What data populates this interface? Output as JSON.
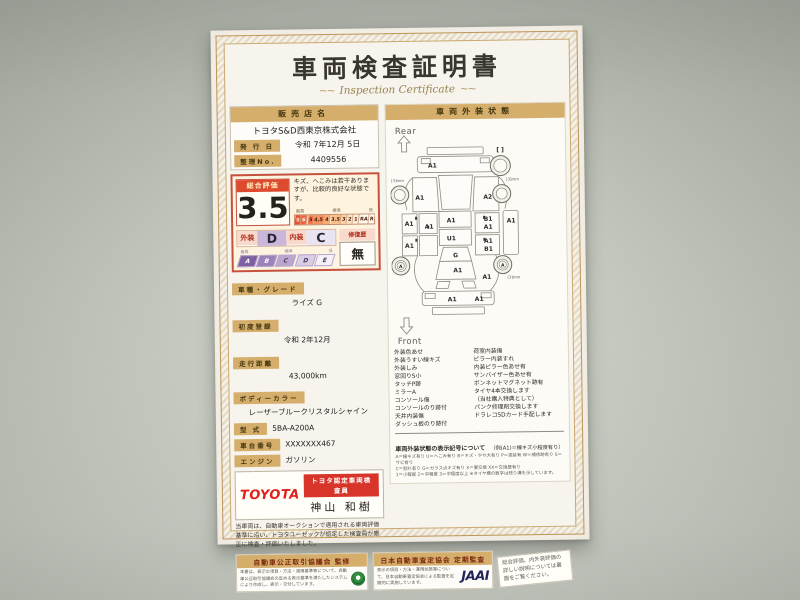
{
  "colors": {
    "accent_tan": "#d5ae6c",
    "accent_red": "#c4513c",
    "toyota_red": "#e0201c"
  },
  "certificate": {
    "title": "車両検査証明書",
    "subtitle": "Inspection Certificate",
    "subtitle_flourish": "~~",
    "dealer": {
      "label": "販売店名",
      "name": "トヨタS&D西東京株式会社"
    },
    "issue_date": {
      "label": "発 行 日",
      "value": "令和 7年12月 5日"
    },
    "control_no": {
      "label": "整理No.",
      "value": "4409556"
    },
    "rating": {
      "label": "総合評価",
      "score": "3.5",
      "comment": "キズ、へこみは若干ありますが、比較的良好な状態です。",
      "scale_high": "最高",
      "scale_mid": "標準",
      "scale_low": "低",
      "scale_cells": [
        "S",
        "6",
        "5",
        "4.5",
        "4",
        "3.5",
        "3",
        "2",
        "1",
        "RA",
        "R"
      ],
      "exterior_label": "外装",
      "exterior_grade": "D",
      "interior_label": "内装",
      "interior_grade": "C",
      "repair_label": "修復歴",
      "repair_value": "無",
      "grade_high": "最高",
      "grade_mid": "標準",
      "grade_low": "低",
      "grade_cells": [
        "A",
        "B",
        "C",
        "D",
        "E"
      ]
    },
    "details": [
      {
        "label": "車種・グレード",
        "value": "ライズ G"
      },
      {
        "label": "初度登録",
        "value": "令和 2年12月"
      },
      {
        "label": "走行距離",
        "value": "43,000km"
      },
      {
        "label": "ボディーカラー",
        "value": "レーザーブルークリスタルシャイン"
      },
      {
        "label": "型 式",
        "value": "5BA-A200A"
      },
      {
        "label": "車台番号",
        "value": "XXXXXXX467"
      },
      {
        "label": "エンジン",
        "value": "ガソリン"
      }
    ],
    "inspector": {
      "brand": "TOYOTA",
      "badge": "トヨタ認定車両検査員",
      "name": "神山 和樹"
    },
    "disclaimer": "当車両は、自動車オークションで適用される車両評価基準に沿い、トヨタユーゼックが認定した検査員が厳正に検査・評価いたしました。",
    "exterior_panel": {
      "header": "車両外装状態",
      "rear_label": "Rear",
      "front_label": "Front",
      "marks": [
        "A1",
        "[ ]",
        "[3]mm",
        "[3]mm",
        "A1",
        "A2",
        "B1",
        "A1",
        "A1",
        "A1",
        "A1",
        "A1",
        "U1",
        "A1",
        "A1",
        "B1",
        "G",
        "A",
        "A",
        "A1",
        "A1",
        "[3]mm",
        "A1",
        "A1"
      ],
      "legend_left": [
        "外装色あせ",
        "外装うすい線キズ",
        "外装しみ",
        "窓回りS小",
        "タッチP跡",
        "ミラーA",
        "コンソール傷",
        "コンソールのり跡付",
        "天井内装傷",
        "ダッシュ板のり跡付"
      ],
      "legend_right": [
        "荷室内装傷",
        "ピラー内装すれ",
        "内装ピラー色あせ有",
        "サンバイザー色あせ有",
        "ボンネットマグネット跡有",
        "タイヤ4本交換します",
        "（当社購入特典として）",
        "パンク修理剤交換します",
        "ドラレコSDカード手配します"
      ],
      "note_title": "車両外装状態の表示記号について",
      "note_example": "（例(A1)＝線キズ小程度有り）",
      "note_lines": [
        "A＝線キズ有り U＝へこみ有り B＝キズ・やや大有り P＝塗装有 W＝補修跡有り S＝サビ有り",
        "C＝割れ有り G＝ガラス点キズ有り X＝要交換 XX＝交換歴有り",
        "1＝小程度 2＝中程度 3＝中程度以上 ※タイヤ横の数字は残り溝を示しています。"
      ]
    },
    "footer": {
      "fair_trade_title": "自動車公正取引協議会 監修",
      "fair_trade_body": "本書は、表示の項目・方法・適用基準等について、自動車公正取引協議会の定める表示基準を満たしたシステムにより作成し、表示・交付しています。",
      "jaai_title": "日本自動車査定協会 定期監査",
      "jaai_body": "表示の項目・方法・運用状態等について、日本自動車査定協会による監査を定期的に実施しています。",
      "jaai_logo": "JAAI",
      "back_note": "総合評価、内外装評価の詳しい説明については裏面をご覧ください。"
    }
  }
}
